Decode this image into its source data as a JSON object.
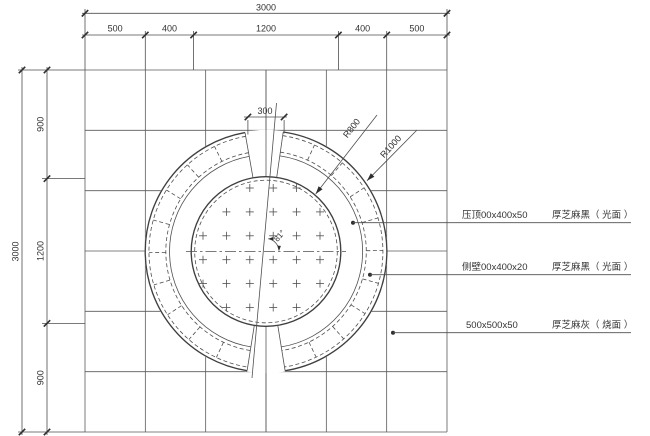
{
  "drawing": {
    "title_hint": "circular paving plan detail",
    "dims": {
      "top_total": "3000",
      "top_segments": [
        "500",
        "400",
        "1200",
        "400",
        "500"
      ],
      "left_total": "3000",
      "left_segments": [
        "900",
        "1200",
        "900"
      ],
      "gap_width": "300",
      "angle": "81°",
      "r_inner": "R800",
      "r_outer": "R1000"
    },
    "callouts": [
      {
        "spec": "压顶00x400x50",
        "material": "厚芝麻黑（ 光面 ）"
      },
      {
        "spec": "侧壁00x400x20",
        "material": "厚芝麻黑（ 光面 ）"
      },
      {
        "spec": "500x500x50",
        "material": "厚芝麻灰（ 烧面 ）"
      }
    ],
    "colors": {
      "line": "#4f4f4f",
      "text": "#333333",
      "background": "#ffffff"
    }
  }
}
